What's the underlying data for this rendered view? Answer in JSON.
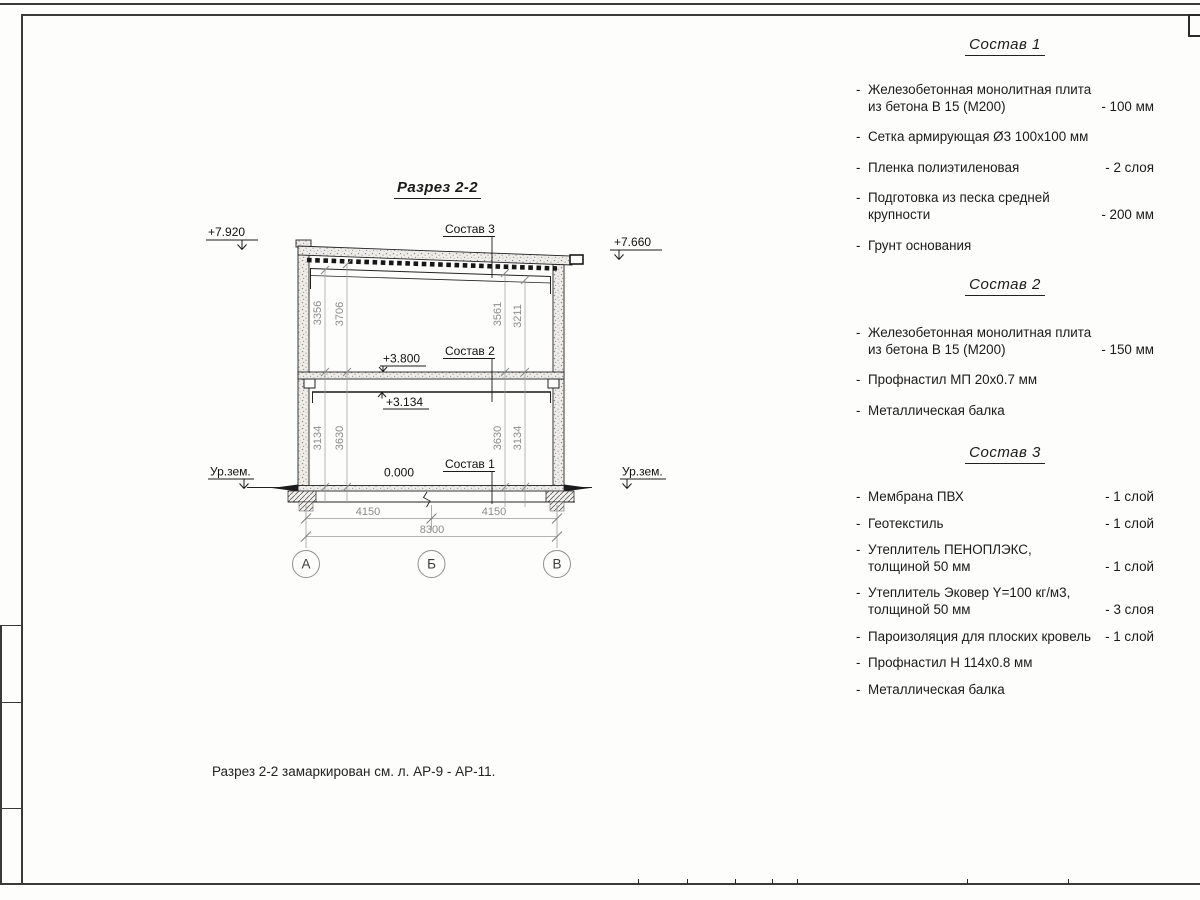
{
  "page": {
    "title": "Разрез 2-2",
    "note": "Разрез 2-2 замаркирован см. л. АР-9 - АР-11."
  },
  "bullet": "-",
  "drawing": {
    "elevations": {
      "roof_left": "+7.920",
      "roof_right": "+7.660",
      "floor2": "+3.800",
      "beam": "+3.134",
      "zero": "0.000"
    },
    "ground_left": "Ур.зем.",
    "ground_right": "Ур.зем.",
    "leaders": {
      "l3": "Состав 3",
      "l2": "Состав 2",
      "l1": "Состав 1"
    },
    "vdims_upper": [
      "3356",
      "3706",
      "3561",
      "3211"
    ],
    "vdims_lower": [
      "3134",
      "3630",
      "3630",
      "3134"
    ],
    "hdims": [
      "4150",
      "4150",
      "8300"
    ],
    "axes": [
      "А",
      "Б",
      "В"
    ]
  },
  "specs": [
    {
      "heading": "Состав 1",
      "items": [
        {
          "name": "Железобетонная  монолитная плита из бетона В 15 (М200)",
          "value": "- 100 мм"
        },
        {
          "name": "Сетка армирующая Ø3 100х100 мм",
          "value": ""
        },
        {
          "name": "Пленка полиэтиленовая",
          "value": "-  2 слоя"
        },
        {
          "name": "Подготовка из песка средней крупности",
          "value": "- 200 мм"
        },
        {
          "name": "Грунт основания",
          "value": ""
        }
      ]
    },
    {
      "heading": "Состав 2",
      "items": [
        {
          "name": "Железобетонная  монолитная плита из бетона В 15 (М200)",
          "value": "- 150 мм"
        },
        {
          "name": "Профнастил МП 20х0.7 мм",
          "value": ""
        },
        {
          "name": "Металлическая балка",
          "value": ""
        }
      ]
    },
    {
      "heading": "Состав 3",
      "items": [
        {
          "name": "Мембрана ПВХ",
          "value": "- 1 слой"
        },
        {
          "name": "Геотекстиль",
          "value": "- 1 слой"
        },
        {
          "name": "Утеплитель ПЕНОПЛЭКС, толщиной 50 мм",
          "value": "- 1 слой"
        },
        {
          "name": "Утеплитель Эковер Y=100 кг/м3, толщиной 50 мм",
          "value": "- 3 слоя"
        },
        {
          "name": "Пароизоляция для плоских кровель",
          "value": "- 1 слой"
        },
        {
          "name": "Профнастил Н 114х0.8 мм",
          "value": ""
        },
        {
          "name": "Металлическая балка",
          "value": ""
        }
      ]
    }
  ]
}
